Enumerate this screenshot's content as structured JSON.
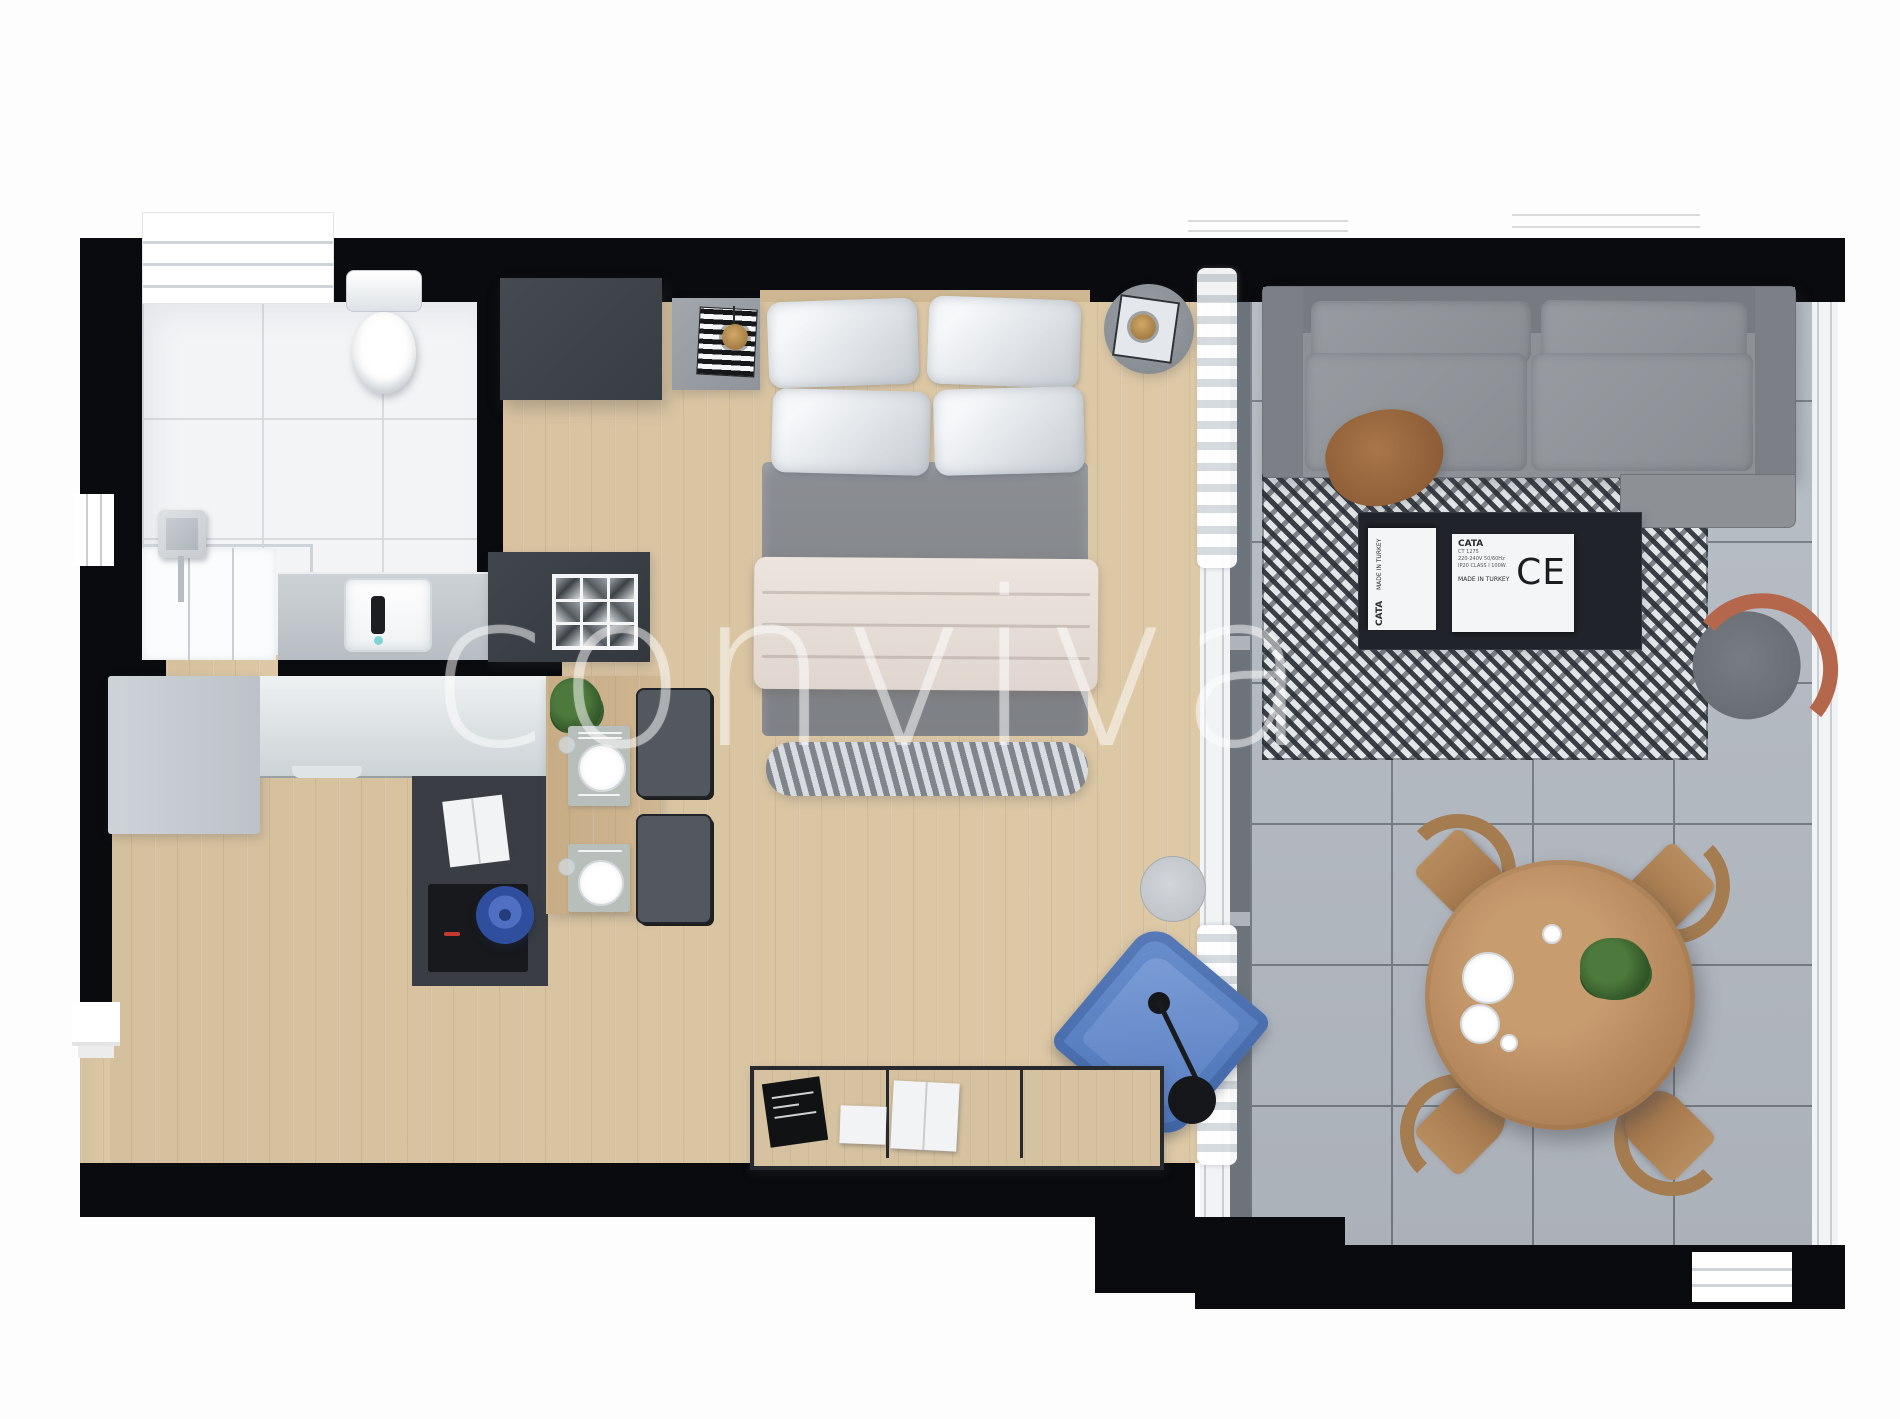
{
  "watermark": {
    "text": "conviva"
  },
  "tags": {
    "main": {
      "brand": "CATA",
      "model": "CT 1275",
      "line1": "220-240V 50/60Hz",
      "line2": "IP20 CLASS I 100W",
      "origin": "MADE IN TURKEY",
      "ce": "CE"
    },
    "side": {
      "brand": "CATA",
      "origin": "MADE IN TURKEY"
    }
  },
  "palette": {
    "wall": "#0a0b0e",
    "wood_floor": "#dcc6a2",
    "bath_tile": "#f2f4f6",
    "terrace_tile": "#b6bcc4",
    "rug_dark": "#2c3138",
    "rug_light": "#e4e7ea",
    "sofa_grey": "#8d9196",
    "accent_blue": "#5b84c6",
    "accent_orange": "#b5674b",
    "brass": "#b08a4a",
    "pot_blue": "#3d5fb0",
    "bed_blanket": "#e9e1da"
  }
}
